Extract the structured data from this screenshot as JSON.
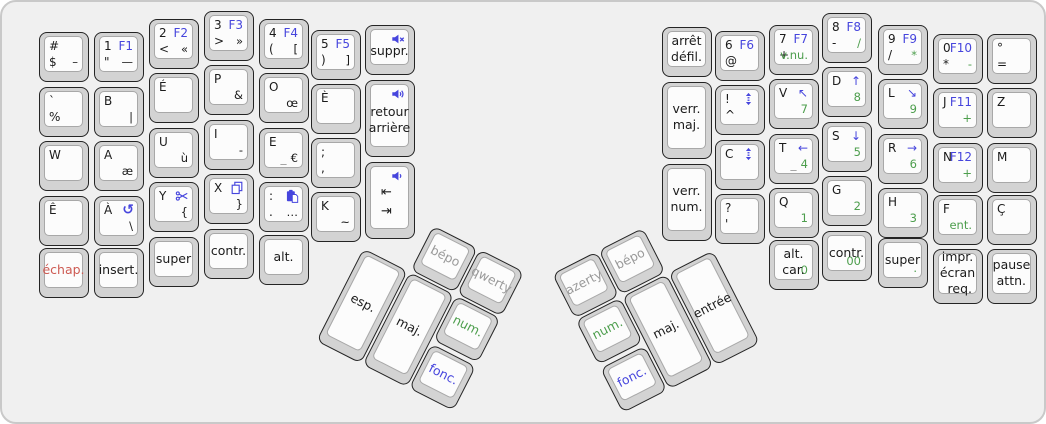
{
  "board": {
    "width": 1046,
    "height": 424,
    "background": "#f0f0f0"
  },
  "colors": {
    "blue": "#4645dd",
    "green": "#4d9e4d",
    "gray": "#9a9a9a",
    "red": "#cd5a52",
    "key_text": "#1b1b1b",
    "cap_base": "#d3d3d3",
    "cap_top": "#fcfcfc"
  },
  "halves": {
    "left": {
      "keys": [
        {
          "id": "dollar",
          "x": 37,
          "y": 30,
          "tl": "#",
          "bl": "$",
          "br": "–"
        },
        {
          "id": "percent",
          "x": 37,
          "y": 85,
          "tl": "`",
          "bl": "%"
        },
        {
          "id": "w",
          "x": 37,
          "y": 139,
          "tl": "W"
        },
        {
          "id": "e-circumflex",
          "x": 37,
          "y": 194,
          "tl": "Ê"
        },
        {
          "id": "escape",
          "x": 37,
          "y": 246,
          "c": [
            "échap."
          ],
          "cc": "red"
        },
        {
          "id": "1-f1",
          "x": 92,
          "y": 30,
          "tl": "1",
          "tr": {
            "t": "F1",
            "c": "blue"
          },
          "bl": "\"",
          "br": "—"
        },
        {
          "id": "b",
          "x": 92,
          "y": 85,
          "tl": "B",
          "br": "|"
        },
        {
          "id": "a",
          "x": 92,
          "y": 139,
          "tl": "A",
          "br": "æ"
        },
        {
          "id": "a-grave",
          "x": 92,
          "y": 194,
          "tl": "À",
          "tr": {
            "icon": "undo"
          },
          "br": "\\"
        },
        {
          "id": "insert",
          "x": 92,
          "y": 246,
          "c": [
            "insert."
          ]
        },
        {
          "id": "2-f2",
          "x": 147,
          "y": 17,
          "tl": "2",
          "tr": {
            "t": "F2",
            "c": "blue"
          },
          "bl": "<",
          "br": "«"
        },
        {
          "id": "e-acute",
          "x": 147,
          "y": 71,
          "tl": "É"
        },
        {
          "id": "u",
          "x": 147,
          "y": 126,
          "tl": "U",
          "br": "ù"
        },
        {
          "id": "y",
          "x": 147,
          "y": 180,
          "tl": "Y",
          "tr": {
            "icon": "scissors"
          },
          "br": "{"
        },
        {
          "id": "super-left",
          "x": 147,
          "y": 235,
          "c": [
            "super"
          ]
        },
        {
          "id": "3-f3",
          "x": 202,
          "y": 9,
          "tl": "3",
          "tr": {
            "t": "F3",
            "c": "blue"
          },
          "bl": ">",
          "br": "»"
        },
        {
          "id": "p",
          "x": 202,
          "y": 63,
          "tl": "P",
          "br": "&"
        },
        {
          "id": "i",
          "x": 202,
          "y": 118,
          "tl": "I",
          "br": "-"
        },
        {
          "id": "x",
          "x": 202,
          "y": 172,
          "tl": "X",
          "tr": {
            "icon": "copy"
          },
          "br": "}"
        },
        {
          "id": "control-left",
          "x": 202,
          "y": 227,
          "c": [
            "contr."
          ]
        },
        {
          "id": "4-f4",
          "x": 257,
          "y": 17,
          "tl": "4",
          "tr": {
            "t": "F4",
            "c": "blue"
          },
          "bl": "(",
          "br": "["
        },
        {
          "id": "o",
          "x": 257,
          "y": 71,
          "tl": "O",
          "br": "œ"
        },
        {
          "id": "e",
          "x": 257,
          "y": 126,
          "tl": "E",
          "bm": {
            "t": "_",
            "c": "gray"
          },
          "br": "€"
        },
        {
          "id": "colon",
          "x": 257,
          "y": 180,
          "tl": ":",
          "tr": {
            "icon": "paste"
          },
          "bl": ".",
          "br": "…"
        },
        {
          "id": "alt",
          "x": 257,
          "y": 233,
          "c": [
            "alt."
          ]
        },
        {
          "id": "5-f5",
          "x": 309,
          "y": 28,
          "tl": "5",
          "tr": {
            "t": "F5",
            "c": "blue"
          },
          "bl": ")",
          "br": "]"
        },
        {
          "id": "e-grave",
          "x": 309,
          "y": 82,
          "tl": "È"
        },
        {
          "id": "semicolon",
          "x": 309,
          "y": 136,
          "tl": ";",
          "bl": ","
        },
        {
          "id": "k",
          "x": 309,
          "y": 190,
          "tl": "K",
          "br": "~"
        },
        {
          "id": "delete",
          "x": 363,
          "y": 23,
          "tr": {
            "icon": "volume-mute"
          },
          "c": [
            "suppr."
          ],
          "ic": true
        },
        {
          "id": "backspace",
          "x": 363,
          "y": 78,
          "h": 77,
          "tr": {
            "icon": "volume-up"
          },
          "c": [
            "retour",
            "arrière"
          ],
          "ic": true
        },
        {
          "id": "tab",
          "x": 363,
          "y": 160,
          "h": 77,
          "tr": {
            "icon": "volume-down"
          },
          "c": [
            "⇤",
            "⇥"
          ],
          "ic": true,
          "tabk": true
        }
      ]
    },
    "right": {
      "keys": [
        {
          "id": "scroll-lock",
          "x": 660,
          "y": 25,
          "c": [
            "arrêt",
            "défil."
          ]
        },
        {
          "id": "caps-lock",
          "x": 660,
          "y": 80,
          "h": 77,
          "c": [
            "verr.",
            "maj."
          ]
        },
        {
          "id": "num-lock",
          "x": 660,
          "y": 162,
          "h": 77,
          "c": [
            "verr.",
            "num."
          ]
        },
        {
          "id": "6-f6",
          "x": 713,
          "y": 29,
          "tl": "6",
          "tr": {
            "t": "F6",
            "c": "blue"
          },
          "bl": "@"
        },
        {
          "id": "exclamation",
          "x": 713,
          "y": 83,
          "tl": "!",
          "tr": {
            "icon": "scroll"
          },
          "bl": "^"
        },
        {
          "id": "c",
          "x": 713,
          "y": 138,
          "tl": "C",
          "tr": {
            "icon": "scroll"
          }
        },
        {
          "id": "question",
          "x": 713,
          "y": 192,
          "tl": "?",
          "bl": "'"
        },
        {
          "id": "7-f7",
          "x": 767,
          "y": 23,
          "tl": "7",
          "tr": {
            "t": "F7",
            "c": "blue"
          },
          "bl": "+",
          "br": {
            "t": "v.nu.",
            "c": "green"
          }
        },
        {
          "id": "v",
          "x": 767,
          "y": 77,
          "tl": "V",
          "tr": {
            "t": "↖",
            "c": "blue"
          },
          "br": {
            "t": "7",
            "c": "green"
          }
        },
        {
          "id": "t",
          "x": 767,
          "y": 132,
          "tl": "T",
          "tr": {
            "t": "←",
            "c": "blue"
          },
          "bm": {
            "t": "_",
            "c": "gray"
          },
          "br": {
            "t": "4",
            "c": "green"
          }
        },
        {
          "id": "q",
          "x": 767,
          "y": 186,
          "tl": "Q",
          "br": {
            "t": "1",
            "c": "green"
          }
        },
        {
          "id": "altgr",
          "x": 767,
          "y": 238,
          "c": [
            "alt.",
            "car."
          ],
          "br": {
            "t": "0",
            "c": "green"
          }
        },
        {
          "id": "8-f8",
          "x": 820,
          "y": 11,
          "tl": "8",
          "tr": {
            "t": "F8",
            "c": "blue"
          },
          "bl": "-",
          "br": {
            "t": "/",
            "c": "green"
          }
        },
        {
          "id": "d",
          "x": 820,
          "y": 65,
          "tl": "D",
          "tr": {
            "t": "↑",
            "c": "blue"
          },
          "br": {
            "t": "8",
            "c": "green"
          }
        },
        {
          "id": "s",
          "x": 820,
          "y": 120,
          "tl": "S",
          "tr": {
            "t": "↓",
            "c": "blue"
          },
          "br": {
            "t": "5",
            "c": "green"
          }
        },
        {
          "id": "g",
          "x": 820,
          "y": 174,
          "tl": "G",
          "br": {
            "t": "2",
            "c": "green"
          }
        },
        {
          "id": "control-right",
          "x": 820,
          "y": 229,
          "c": [
            "contr."
          ],
          "br": {
            "t": "00",
            "c": "green"
          }
        },
        {
          "id": "9-f9",
          "x": 876,
          "y": 23,
          "tl": "9",
          "tr": {
            "t": "F9",
            "c": "blue"
          },
          "bl": "/",
          "br": {
            "t": "*",
            "c": "green"
          }
        },
        {
          "id": "l",
          "x": 876,
          "y": 77,
          "tl": "L",
          "tr": {
            "t": "↘",
            "c": "blue"
          },
          "br": {
            "t": "9",
            "c": "green"
          }
        },
        {
          "id": "r",
          "x": 876,
          "y": 132,
          "tl": "R",
          "tr": {
            "t": "→",
            "c": "blue"
          },
          "br": {
            "t": "6",
            "c": "green"
          }
        },
        {
          "id": "h",
          "x": 876,
          "y": 186,
          "tl": "H",
          "br": {
            "t": "3",
            "c": "green"
          }
        },
        {
          "id": "super-right",
          "x": 876,
          "y": 236,
          "c": [
            "super"
          ],
          "br": {
            "t": ".",
            "c": "green"
          }
        },
        {
          "id": "0-f10",
          "x": 931,
          "y": 32,
          "tl": "0",
          "tr": {
            "t": "F10",
            "c": "blue"
          },
          "bl": "*",
          "br": {
            "t": "-",
            "c": "green"
          }
        },
        {
          "id": "j-f11",
          "x": 931,
          "y": 86,
          "tl": "J",
          "tr": {
            "t": "F11",
            "c": "blue"
          },
          "br": {
            "t": "+",
            "c": "green"
          }
        },
        {
          "id": "n-f12",
          "x": 931,
          "y": 141,
          "tl": "N",
          "tr": {
            "t": "F12",
            "c": "blue"
          },
          "br": {
            "t": "+",
            "c": "green"
          }
        },
        {
          "id": "f",
          "x": 931,
          "y": 193,
          "tl": "F",
          "br": {
            "t": "ent.",
            "c": "green"
          }
        },
        {
          "id": "print-screen",
          "x": 931,
          "y": 247,
          "h": 55,
          "c": [
            "impr.",
            "écran",
            "req."
          ],
          "spread": true
        },
        {
          "id": "degree",
          "x": 985,
          "y": 32,
          "tl": "°",
          "bl": "="
        },
        {
          "id": "z",
          "x": 985,
          "y": 86,
          "tl": "Z"
        },
        {
          "id": "m",
          "x": 985,
          "y": 141,
          "tl": "M"
        },
        {
          "id": "c-cedilla",
          "x": 985,
          "y": 193,
          "tl": "Ç"
        },
        {
          "id": "pause",
          "x": 985,
          "y": 247,
          "h": 55,
          "c": [
            "pause",
            "attn."
          ],
          "spread": true
        }
      ]
    }
  },
  "thumb_clusters": {
    "left": {
      "origin": {
        "x": 385,
        "y": 200
      },
      "rotation": 27,
      "keys": [
        {
          "id": "bepo-left",
          "x": 52,
          "y": 0,
          "c": [
            "bépo"
          ],
          "cc": "gray"
        },
        {
          "id": "qwerty",
          "x": 104,
          "y": 0,
          "c": [
            "qwerty"
          ],
          "cc": "gray"
        },
        {
          "id": "space",
          "x": 0,
          "y": 52,
          "h": 104,
          "c": [
            "esp."
          ]
        },
        {
          "id": "shift-left",
          "x": 52,
          "y": 52,
          "h": 104,
          "c": [
            "maj."
          ]
        },
        {
          "id": "num-left",
          "x": 104,
          "y": 52,
          "c": [
            "num."
          ],
          "cc": "green"
        },
        {
          "id": "fn-left",
          "x": 104,
          "y": 106,
          "c": [
            "fonc."
          ],
          "cc": "blue"
        }
      ]
    },
    "right": {
      "origin": {
        "x": 550,
        "y": 272
      },
      "rotation": -27,
      "keys": [
        {
          "id": "azerty",
          "x": 0,
          "y": 0,
          "c": [
            "azerty"
          ],
          "cc": "gray"
        },
        {
          "id": "bepo-right",
          "x": 52,
          "y": 0,
          "c": [
            "bépo"
          ],
          "cc": "gray"
        },
        {
          "id": "num-right",
          "x": 0,
          "y": 52,
          "c": [
            "num."
          ],
          "cc": "green"
        },
        {
          "id": "fn-right",
          "x": 0,
          "y": 106,
          "c": [
            "fonc."
          ],
          "cc": "blue"
        },
        {
          "id": "shift-right",
          "x": 52,
          "y": 52,
          "h": 104,
          "c": [
            "maj."
          ]
        },
        {
          "id": "enter",
          "x": 104,
          "y": 52,
          "h": 104,
          "c": [
            "entrée"
          ]
        }
      ]
    }
  }
}
